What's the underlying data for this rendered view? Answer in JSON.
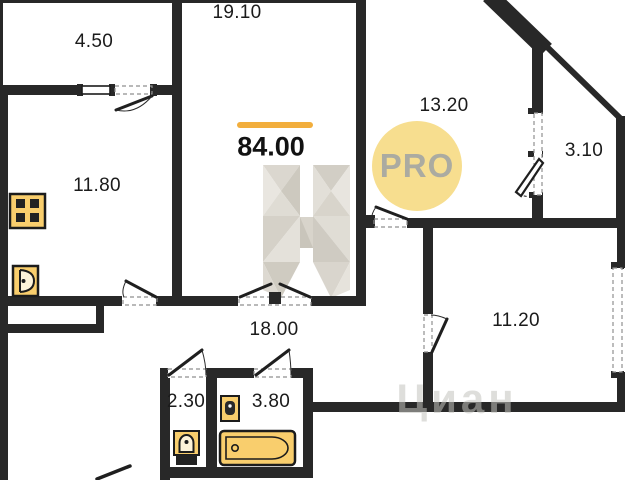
{
  "floor_plan": {
    "type": "apartment-floor-plan",
    "total_area_label": "84.00",
    "pro_badge_label": "PRO",
    "watermark_text": "Циан",
    "rooms": [
      {
        "name": "balcony-top-left",
        "area": "4.50"
      },
      {
        "name": "room-top-center",
        "area": "19.10"
      },
      {
        "name": "room-right",
        "area": "13.20"
      },
      {
        "name": "balcony-right",
        "area": "3.10"
      },
      {
        "name": "kitchen-left",
        "area": "11.80"
      },
      {
        "name": "hallway",
        "area": "18.00"
      },
      {
        "name": "room-bottom-right",
        "area": "11.20"
      },
      {
        "name": "wc",
        "area": "2.30"
      },
      {
        "name": "bathroom",
        "area": "3.80"
      }
    ],
    "icons": [
      {
        "name": "stove-icon",
        "room": "kitchen-left"
      },
      {
        "name": "kitchen-sink-icon",
        "room": "kitchen-left"
      },
      {
        "name": "toilet-icon",
        "room": "wc"
      },
      {
        "name": "sink-icon",
        "room": "bathroom"
      },
      {
        "name": "bathtub-icon",
        "room": "bathroom"
      }
    ],
    "colors": {
      "wall": "#282828",
      "accent_line": "#F2AE3C",
      "pro_badge_fill": "#F7DE8F",
      "pro_badge_text": "#ABABA1",
      "fixture_fill": "#F9CE6D",
      "watermark_gray": "#D8D4CC"
    }
  }
}
